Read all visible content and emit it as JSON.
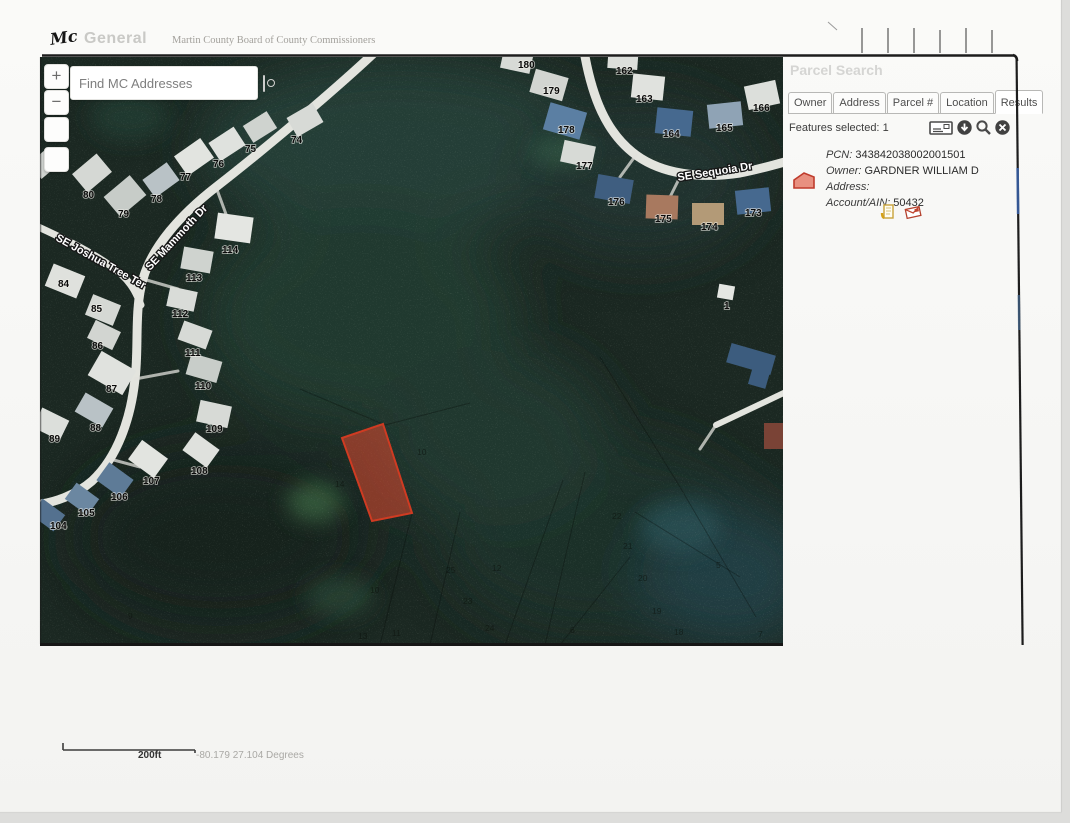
{
  "header": {
    "logo_mark": "Mc",
    "app_name": "General",
    "org_name": "Martin County Board of County Commissioners"
  },
  "map": {
    "search_value": "Find MC Addresses",
    "zoom_in_label": "+",
    "zoom_out_label": "−",
    "street_labels": [
      {
        "text": "SE Joshua Tree Ter",
        "x": 15,
        "y": 183,
        "rot": 29
      },
      {
        "text": "SE Mammoth Dr",
        "x": 110,
        "y": 214,
        "rot": -47
      },
      {
        "text": "SE Sequoia Dr",
        "x": 638,
        "y": 124,
        "rot": -9
      }
    ],
    "house_numbers": [
      {
        "n": "74",
        "x": 251,
        "y": 86
      },
      {
        "n": "75",
        "x": 205,
        "y": 95
      },
      {
        "n": "76",
        "x": 173,
        "y": 110
      },
      {
        "n": "77",
        "x": 140,
        "y": 123
      },
      {
        "n": "78",
        "x": 111,
        "y": 145
      },
      {
        "n": "79",
        "x": 78,
        "y": 160
      },
      {
        "n": "80",
        "x": 43,
        "y": 141
      },
      {
        "n": "84",
        "x": 18,
        "y": 230
      },
      {
        "n": "85",
        "x": 51,
        "y": 255
      },
      {
        "n": "114",
        "x": 182,
        "y": 196
      },
      {
        "n": "113",
        "x": 146,
        "y": 224
      },
      {
        "n": "112",
        "x": 132,
        "y": 260
      },
      {
        "n": "86",
        "x": 52,
        "y": 292
      },
      {
        "n": "111",
        "x": 145,
        "y": 299
      },
      {
        "n": "87",
        "x": 66,
        "y": 335
      },
      {
        "n": "110",
        "x": 155,
        "y": 332
      },
      {
        "n": "88",
        "x": 50,
        "y": 374
      },
      {
        "n": "109",
        "x": 166,
        "y": 375
      },
      {
        "n": "89",
        "x": 9,
        "y": 385
      },
      {
        "n": "108",
        "x": 151,
        "y": 417
      },
      {
        "n": "107",
        "x": 103,
        "y": 427
      },
      {
        "n": "106",
        "x": 71,
        "y": 443
      },
      {
        "n": "105",
        "x": 38,
        "y": 459
      },
      {
        "n": "104",
        "x": 10,
        "y": 472
      },
      {
        "n": "180",
        "x": 478,
        "y": 11
      },
      {
        "n": "162",
        "x": 576,
        "y": 17
      },
      {
        "n": "179",
        "x": 503,
        "y": 37
      },
      {
        "n": "163",
        "x": 596,
        "y": 45
      },
      {
        "n": "166",
        "x": 713,
        "y": 54
      },
      {
        "n": "178",
        "x": 518,
        "y": 76
      },
      {
        "n": "164",
        "x": 623,
        "y": 80
      },
      {
        "n": "165",
        "x": 676,
        "y": 74
      },
      {
        "n": "177",
        "x": 536,
        "y": 112
      },
      {
        "n": "176",
        "x": 568,
        "y": 148
      },
      {
        "n": "175",
        "x": 615,
        "y": 165
      },
      {
        "n": "174",
        "x": 661,
        "y": 173
      },
      {
        "n": "173",
        "x": 705,
        "y": 159
      },
      {
        "n": "1",
        "x": 684,
        "y": 252
      }
    ],
    "faint_numbers": [
      {
        "n": "14",
        "x": 295,
        "y": 430
      },
      {
        "n": "10",
        "x": 377,
        "y": 398
      },
      {
        "n": "22",
        "x": 572,
        "y": 462
      },
      {
        "n": "21",
        "x": 583,
        "y": 492
      },
      {
        "n": "20",
        "x": 598,
        "y": 524
      },
      {
        "n": "19",
        "x": 612,
        "y": 557
      },
      {
        "n": "18",
        "x": 634,
        "y": 578
      },
      {
        "n": "23",
        "x": 423,
        "y": 547
      },
      {
        "n": "24",
        "x": 445,
        "y": 574
      },
      {
        "n": "25",
        "x": 406,
        "y": 516
      },
      {
        "n": "6",
        "x": 530,
        "y": 576
      },
      {
        "n": "5",
        "x": 676,
        "y": 511
      },
      {
        "n": "10",
        "x": 330,
        "y": 536
      },
      {
        "n": "11",
        "x": 352,
        "y": 579
      },
      {
        "n": "13",
        "x": 318,
        "y": 582
      },
      {
        "n": "12",
        "x": 452,
        "y": 514
      },
      {
        "n": "7",
        "x": 718,
        "y": 580
      },
      {
        "n": "9",
        "x": 88,
        "y": 562
      }
    ]
  },
  "panel": {
    "title": "Parcel Search",
    "tabs": [
      "Owner",
      "Address",
      "Parcel #",
      "Location",
      "Results"
    ],
    "active_tab": "Results",
    "features_label": "Features selected:",
    "features_count": "1",
    "result": {
      "pcn_label": "PCN",
      "pcn": "343842038002001501",
      "owner_label": "Owner",
      "owner": "GARDNER WILLIAM D",
      "address_label": "Address",
      "address": "",
      "account_label": "Account/AIN",
      "account": "50432"
    }
  },
  "footer": {
    "scale_label": "200ft",
    "coordinates": "-80.179 27.104 Degrees"
  },
  "colors": {
    "selected_parcel_fill": "#e04830",
    "selected_parcel_stroke": "#cf3b22",
    "forest_base": "#1b2822",
    "road": "#e3e4de"
  }
}
